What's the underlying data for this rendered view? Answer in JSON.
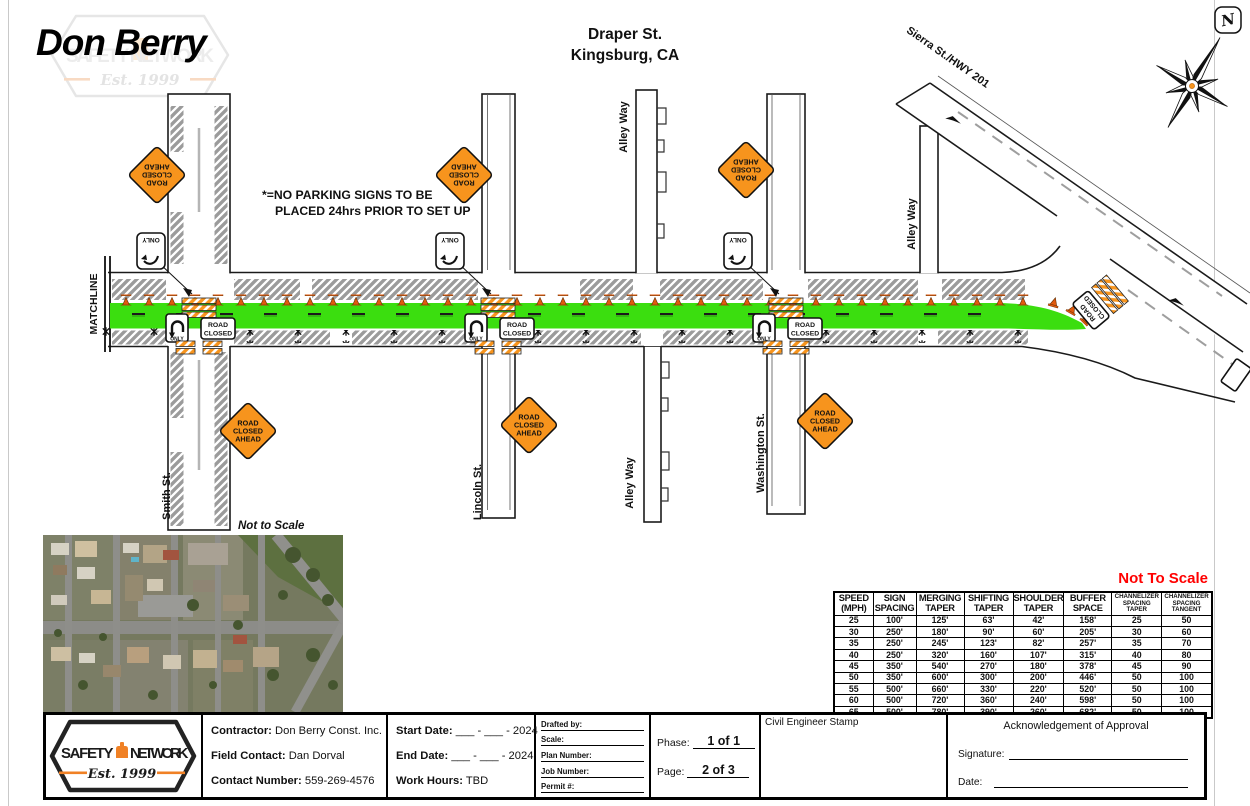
{
  "header": {
    "client_name": "Don Berry",
    "watermark_line1": "SAFETY NETWORK",
    "watermark_est": "Est. 1999",
    "title_line1": "Draper St.",
    "title_line2": "Kingsburg, CA",
    "compass_n": "N"
  },
  "map": {
    "note_line1": "*=NO PARKING SIGNS TO BE",
    "note_line2": "PLACED 24hrs PRIOR TO SET UP",
    "not_to_scale": "Not to Scale",
    "streets": {
      "matchline": "MATCHLINE",
      "smith": "Smith St.",
      "lincoln": "Lincoln St.",
      "washington": "Washington St.",
      "alley_top": "Alley Way",
      "alley_bottom": "Alley Way",
      "alley_right": "Alley Way",
      "sierra": "Sierra St./HWY 201"
    },
    "signs": {
      "road_closed_ahead": [
        "ROAD",
        "CLOSED",
        "AHEAD"
      ],
      "road_closed": [
        "ROAD",
        "CLOSED"
      ],
      "only": "ONLY"
    },
    "colors": {
      "work_area_green": "#3BDE0F",
      "traffic_orange": "#F7941D",
      "hatch_gray": "#9B9B9B",
      "not_to_scale_red": "#FF0000"
    }
  },
  "taper_table": {
    "not_to_scale": "Not To Scale",
    "headers": [
      "SPEED (MPH)",
      "SIGN SPACING",
      "MERGING TAPER",
      "SHIFTING TAPER",
      "SHOULDER TAPER",
      "BUFFER SPACE",
      "CHANNELIZER SPACING TAPER",
      "CHANNELIZER SPACING TANGENT"
    ],
    "rows": [
      [
        "25",
        "100'",
        "125'",
        "63'",
        "42'",
        "158'",
        "25",
        "50"
      ],
      [
        "30",
        "250'",
        "180'",
        "90'",
        "60'",
        "205'",
        "30",
        "60"
      ],
      [
        "35",
        "250'",
        "245'",
        "123'",
        "82'",
        "257'",
        "35",
        "70"
      ],
      [
        "40",
        "250'",
        "320'",
        "160'",
        "107'",
        "315'",
        "40",
        "80"
      ],
      [
        "45",
        "350'",
        "540'",
        "270'",
        "180'",
        "378'",
        "45",
        "90"
      ],
      [
        "50",
        "350'",
        "600'",
        "300'",
        "200'",
        "446'",
        "50",
        "100"
      ],
      [
        "55",
        "500'",
        "660'",
        "330'",
        "220'",
        "520'",
        "50",
        "100"
      ],
      [
        "60",
        "500'",
        "720'",
        "360'",
        "240'",
        "598'",
        "50",
        "100"
      ],
      [
        "65",
        "500'",
        "780'",
        "390'",
        "260'",
        "682'",
        "50",
        "100"
      ]
    ]
  },
  "title_block": {
    "logo": {
      "word1": "SAFETY",
      "word2": "NETWORK",
      "est": "Est. 1999"
    },
    "contractor_label": "Contractor:",
    "contractor_value": "Don Berry Const. Inc.",
    "field_contact_label": "Field Contact:",
    "field_contact_value": "Dan Dorval",
    "contact_number_label": "Contact Number:",
    "contact_number_value": "559-269-4576",
    "start_date_label": "Start Date:",
    "start_date_value": "___ - ___ - 2024",
    "end_date_label": "End Date:",
    "end_date_value": "___ - ___ - 2024",
    "work_hours_label": "Work Hours:",
    "work_hours_value": "TBD",
    "drafted_by_label": "Drafted by:",
    "scale_label": "Scale:",
    "plan_number_label": "Plan Number:",
    "job_number_label": "Job Number:",
    "permit_label": "Permit #:",
    "phase_label": "Phase:",
    "phase_value": "1 of 1",
    "page_label": "Page:",
    "page_value": "2 of 3",
    "stamp_label": "Civil Engineer Stamp",
    "approval_title": "Acknowledgement of Approval",
    "signature_label": "Signature:",
    "date_label": "Date:"
  }
}
